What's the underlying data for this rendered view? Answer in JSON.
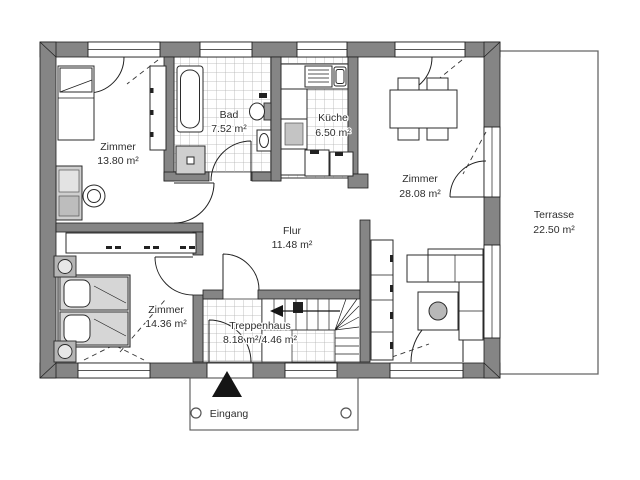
{
  "rooms": [
    {
      "name": "Zimmer",
      "area": "13.80 m²"
    },
    {
      "name": "Bad",
      "area": "7.52 m²"
    },
    {
      "name": "Küche",
      "area": "6.50 m²"
    },
    {
      "name": "Zimmer",
      "area": "28.08 m²"
    },
    {
      "name": "Flur",
      "area": "11.48 m²"
    },
    {
      "name": "Zimmer",
      "area": "14.36 m²"
    },
    {
      "name": "Treppenhaus",
      "area": "8.18 m²/4.46 m²"
    },
    {
      "name": "Terrasse",
      "area": "22.50 m²"
    }
  ],
  "entrance": {
    "label": "Eingang"
  },
  "colors": {
    "wall": "#858585",
    "outline": "#1f1f1f",
    "tile_line": "#b0b0b0",
    "text": "#2e2e2e",
    "terrace_line": "#666666",
    "accent_dark": "#151515"
  }
}
